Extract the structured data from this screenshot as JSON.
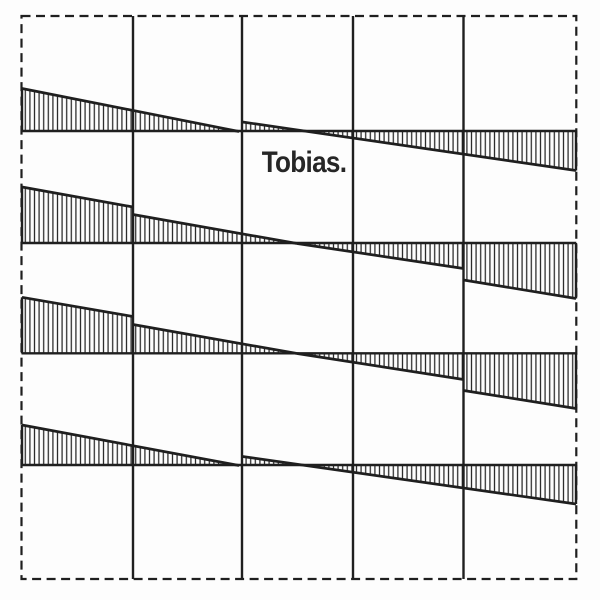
{
  "label": {
    "text": "Tobias."
  },
  "colors": {
    "background": "#fdfdfd",
    "ink": "#1f1f1f",
    "hatch_stroke": "#262626",
    "text": "#262626"
  },
  "canvas": {
    "width": 600,
    "height": 600
  },
  "border": {
    "x": 21.5,
    "y": 16,
    "width": 554.8,
    "height": 563,
    "dash": "9 5.5",
    "stroke_width": 2.2
  },
  "grid": {
    "column_lines_x": [
      133,
      242,
      353,
      463.5
    ],
    "row_span": [
      16,
      579
    ],
    "row_lines_y": [
      131,
      243,
      353.3,
      465
    ],
    "col_span": [
      21.5,
      576.3
    ],
    "stroke_width": 2.4
  },
  "hatch": {
    "spacing": 4.6,
    "stroke_width": 1.25,
    "edge_stroke_width": 2.7,
    "cap_stroke_width": 2.4
  },
  "bands": [
    {
      "row_line_y": 131,
      "segments": [
        {
          "x1": 22,
          "y1": 88.5,
          "x2": 239,
          "y2": 131.5,
          "left_cap": true,
          "right_cap": false
        },
        {
          "x1": 242.5,
          "y1": 122,
          "x2": 576,
          "y2": 170.5,
          "left_cap": false,
          "right_cap": true
        }
      ]
    },
    {
      "row_line_y": 243,
      "segments": [
        {
          "x1": 22,
          "y1": 187,
          "x2": 133,
          "y2": 207,
          "left_cap": true,
          "right_cap": false
        },
        {
          "x1": 133,
          "y1": 214.5,
          "x2": 297,
          "y2": 243.5,
          "left_cap": false,
          "right_cap": false
        },
        {
          "x1": 297,
          "y1": 243.5,
          "x2": 463.5,
          "y2": 268.5,
          "left_cap": false,
          "right_cap": false
        },
        {
          "x1": 463.5,
          "y1": 280,
          "x2": 576,
          "y2": 298.5,
          "left_cap": false,
          "right_cap": true
        }
      ]
    },
    {
      "row_line_y": 353.3,
      "segments": [
        {
          "x1": 22,
          "y1": 297.3,
          "x2": 133,
          "y2": 316.5,
          "left_cap": true,
          "right_cap": false
        },
        {
          "x1": 133,
          "y1": 324.5,
          "x2": 297,
          "y2": 353.5,
          "left_cap": false,
          "right_cap": false
        },
        {
          "x1": 297,
          "y1": 353.5,
          "x2": 463.5,
          "y2": 379.5,
          "left_cap": false,
          "right_cap": false
        },
        {
          "x1": 463.5,
          "y1": 390.5,
          "x2": 576,
          "y2": 408.5,
          "left_cap": false,
          "right_cap": true
        }
      ]
    },
    {
      "row_line_y": 465,
      "segments": [
        {
          "x1": 22,
          "y1": 425,
          "x2": 239,
          "y2": 465.5,
          "left_cap": true,
          "right_cap": false
        },
        {
          "x1": 242.5,
          "y1": 456.5,
          "x2": 576,
          "y2": 504,
          "left_cap": false,
          "right_cap": true
        }
      ]
    }
  ]
}
